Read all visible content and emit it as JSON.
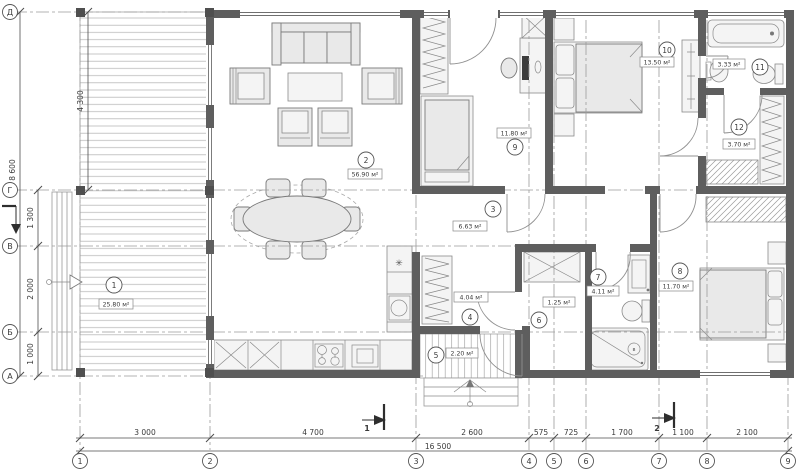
{
  "plan": {
    "rooms": [
      {
        "num": "1",
        "area": "25.80 м²"
      },
      {
        "num": "2",
        "area": "56.90 м²"
      },
      {
        "num": "3",
        "area": "6.63 м²"
      },
      {
        "num": "4",
        "area": "4.04 м²"
      },
      {
        "num": "5",
        "area": "2.20 м²"
      },
      {
        "num": "6",
        "area": "1.25 м²"
      },
      {
        "num": "7",
        "area": "4.11 м²"
      },
      {
        "num": "8",
        "area": "11.70 м²"
      },
      {
        "num": "9",
        "area": "11.80 м²"
      },
      {
        "num": "10",
        "area": "13.50 м²"
      },
      {
        "num": "11",
        "area": "3.33 м²"
      },
      {
        "num": "12",
        "area": "3.70 м²"
      }
    ],
    "axes_bottom": [
      "1",
      "2",
      "3",
      "4",
      "5",
      "6",
      "7",
      "8",
      "9"
    ],
    "axes_left": [
      "Д",
      "Г",
      "В",
      "Б",
      "А"
    ],
    "dims_bottom": [
      "3 000",
      "4 700",
      "2 600",
      "575",
      "725",
      "1 700",
      "1 100",
      "2 100"
    ],
    "total_bottom": "16 500",
    "dims_left": [
      "4 300",
      "1 300",
      "2 000",
      "1 000"
    ],
    "total_left": "8 600",
    "sections": [
      "1",
      "2"
    ],
    "symbols": {
      "boiler": "✳",
      "drain": "в"
    },
    "colors": {
      "wall": "#5e5e5e",
      "furniture": "#e9e9e9",
      "hatch": "#9a9a9a"
    }
  }
}
